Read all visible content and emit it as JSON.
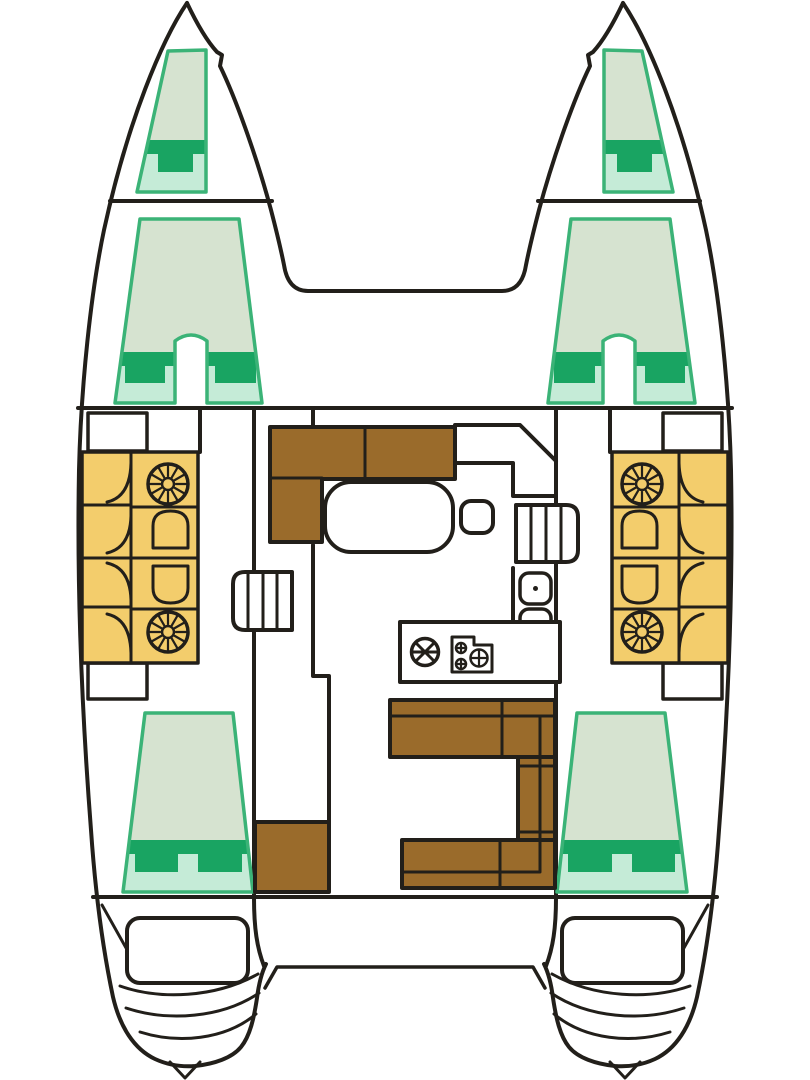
{
  "meta": {
    "domain": "Diagram",
    "diagram_type": "boat-floor-plan",
    "description": "Top-view interior layout plan of a four-cabin sailing catamaran"
  },
  "colors": {
    "bg": "#ffffff",
    "line": "#221f1a",
    "hullFill": "#ffffff",
    "bedFill": "#d6e3d0",
    "bedMint": "#c5ebd7",
    "bedBorder": "#3bb377",
    "bedDark": "#19a462",
    "settee": "#f3cd6c",
    "wood": "#9a6b2b"
  }
}
